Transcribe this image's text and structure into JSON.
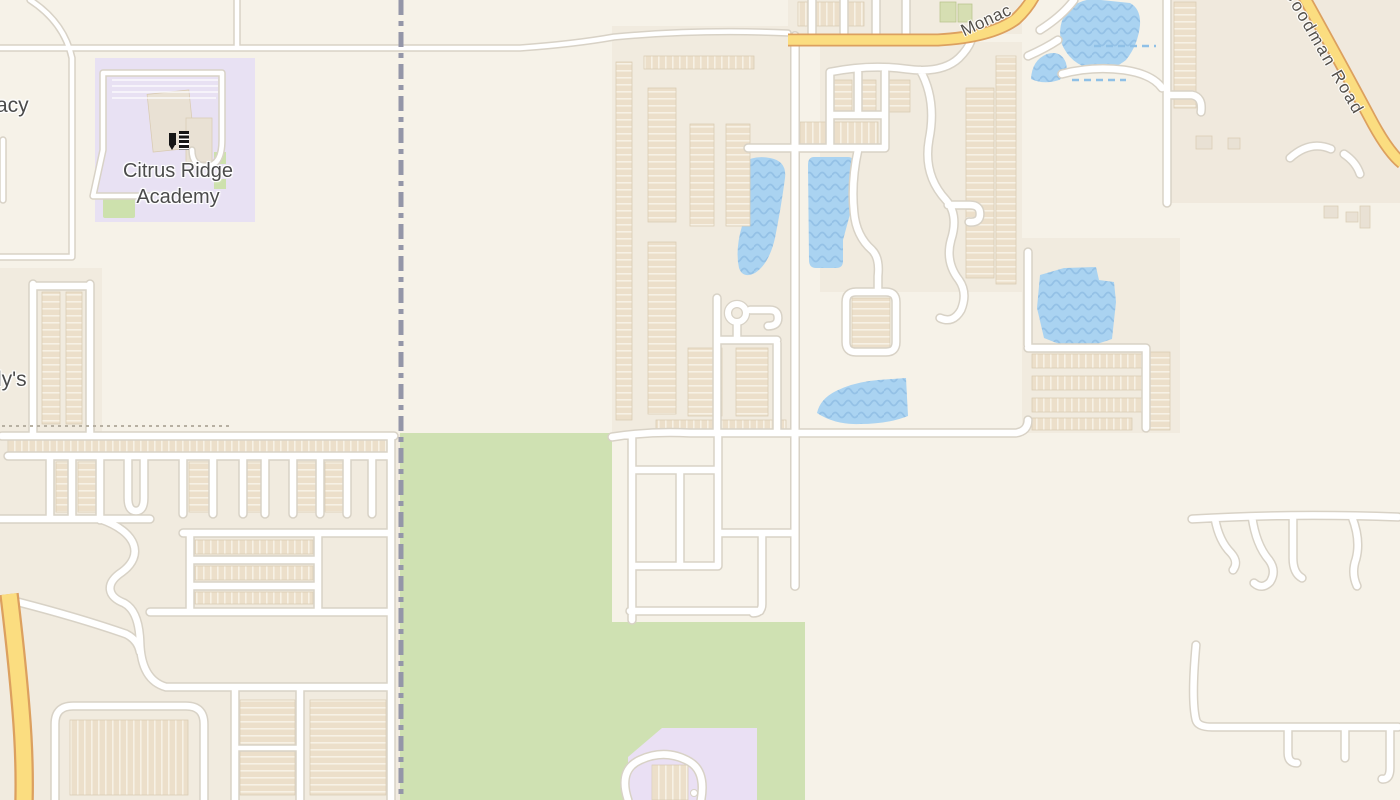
{
  "page": {
    "type": "map-viewer",
    "description": "street map tile view"
  },
  "map": {
    "labels": {
      "school_name_line1": "Citrus Ridge",
      "school_name_line2": "Academy",
      "partial_label_top_left": "acy",
      "partial_label_mid_left": "ly's",
      "road_label_top": "Monac",
      "road_label_top_right": "Goodman Road"
    },
    "icons": {
      "school": "school-icon"
    },
    "colors": {
      "background": "#f6f2e8",
      "residential": "#f1ebdf",
      "dark_region": "#f0e9dd",
      "building": "#ecdfca",
      "building_stroke": "#d9cbb3",
      "building_plain": "#e9e1d4",
      "green_building": "#d6deb2",
      "road_fill": "#ffffff",
      "road_casing": "#d8d2c6",
      "road_primary_fill": "#fbdd80",
      "road_primary_casing": "#dca05f",
      "water_fill": "#aad3f1",
      "water_wave": "#94c1e6",
      "park": "#cfe1b2",
      "park_patch": "#cde1ad",
      "school_area": "#e8e1f3",
      "purple_area": "#eae0f4",
      "boundary": "#9496a8",
      "stream": "#8fc0e6",
      "path_dotted": "#b7b0a2",
      "label_text": "#4b4b4b",
      "road_label_text": "#54504a"
    }
  }
}
